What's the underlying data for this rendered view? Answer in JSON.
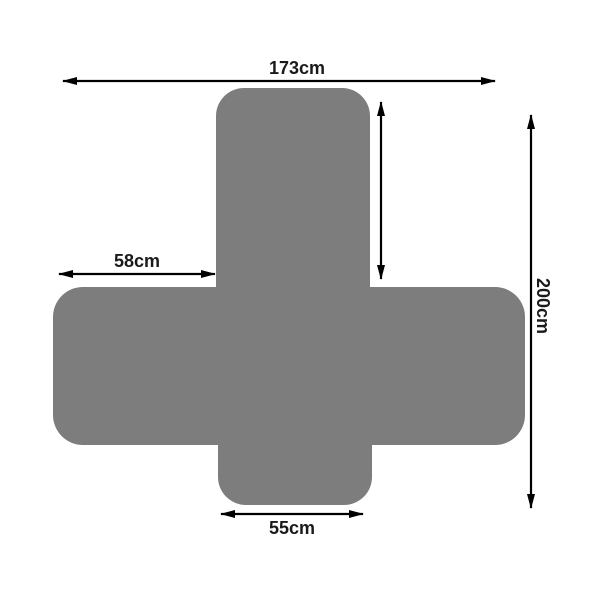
{
  "diagram": {
    "kind": "product-dimension-diagram",
    "subject": "sofa-cover-flat-layout",
    "colors": {
      "shape": "#7d7d7d",
      "arrow": "#000000",
      "label_text": "#1a1a1a",
      "background": "#ffffff"
    },
    "dimensions": {
      "top_width": {
        "label": "173cm"
      },
      "left_overhang": {
        "label": "58cm"
      },
      "total_length": {
        "label": "200cm"
      },
      "bottom_flap_width": {
        "label": "55cm"
      },
      "backrest_height": {
        "label": ""
      }
    }
  }
}
